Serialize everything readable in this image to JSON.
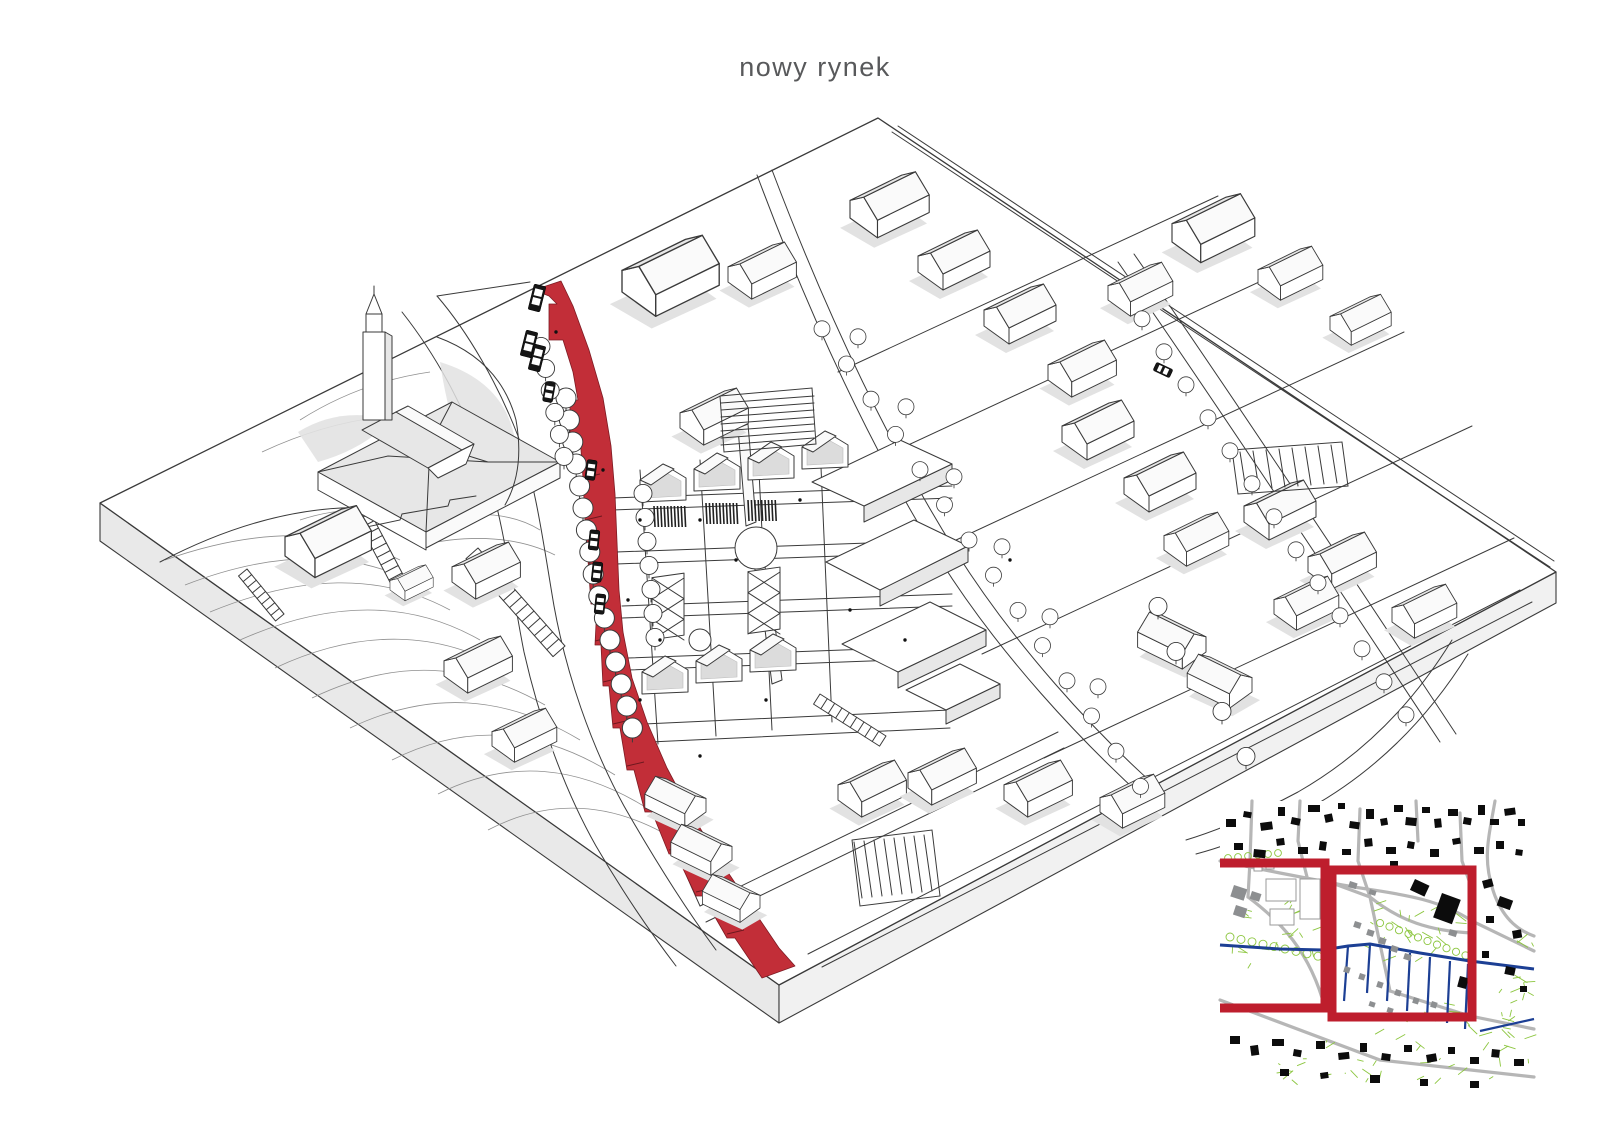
{
  "page": {
    "title": "nowy rynek"
  },
  "colors": {
    "accent_red": "#c22e38",
    "frame_red": "#be1e2d",
    "route_blue": "#1c3f94",
    "greenery": "#8cc63f",
    "road_gray": "#b6b6b6",
    "ink": "#3a3a3a",
    "plate_side": "#e9e9e9",
    "shadow": "#e2e2e2"
  },
  "axon": {
    "label": "axonometric masterplan view of the new market square",
    "elements": [
      "base-plate",
      "red-promenade",
      "church-complex",
      "market-row-houses",
      "pergolas",
      "tree-rows",
      "existing-street",
      "housing-grid",
      "parking-lots",
      "stairs",
      "vehicles"
    ]
  },
  "inset": {
    "label": "location plan with project area frames",
    "frames": [
      "context-area-frame",
      "detail-area-frame"
    ]
  }
}
